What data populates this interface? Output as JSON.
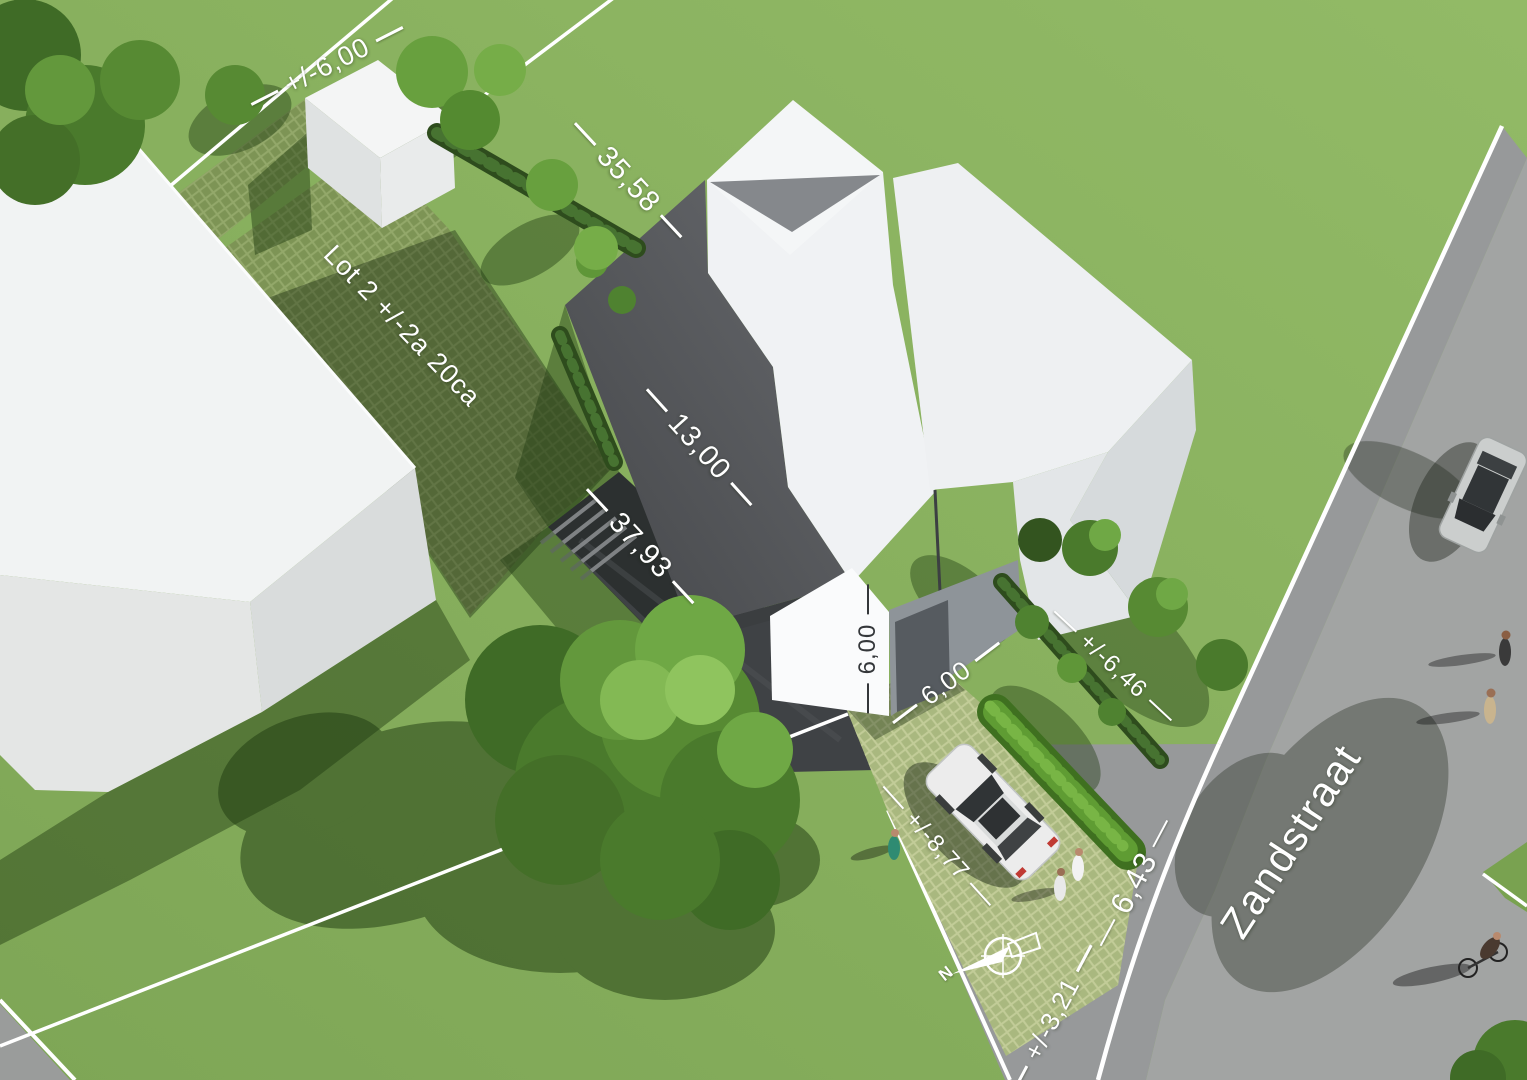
{
  "site_plan": {
    "street_name": "Zandstraat",
    "lot_label": "Lot 2 +/-2a 20ca",
    "north_label": "N",
    "dimensions": {
      "rear_boundary": "+/-6,00",
      "side_boundary_length": "35,58",
      "house_width": "13,00",
      "plot_depth": "37,93",
      "facade_height": "6,00",
      "front_setback": "6,00",
      "roadside_hedge": "+/-6,46",
      "frontage_width": "+/-8,77",
      "road_width": "6,43",
      "verge_width": "+/-3,21"
    },
    "colors": {
      "grass": "#8ab35f",
      "road_asphalt": "#a2a4a3",
      "sidewalk": "#97999a",
      "dark_roof": "#53555a",
      "building_white": "#f2f4f5",
      "hedge_dark": "#2e4c1d",
      "paver_olive": "#a9b87f",
      "driveway_asphalt": "#3f4245",
      "dimension_text": "#ffffff"
    }
  }
}
